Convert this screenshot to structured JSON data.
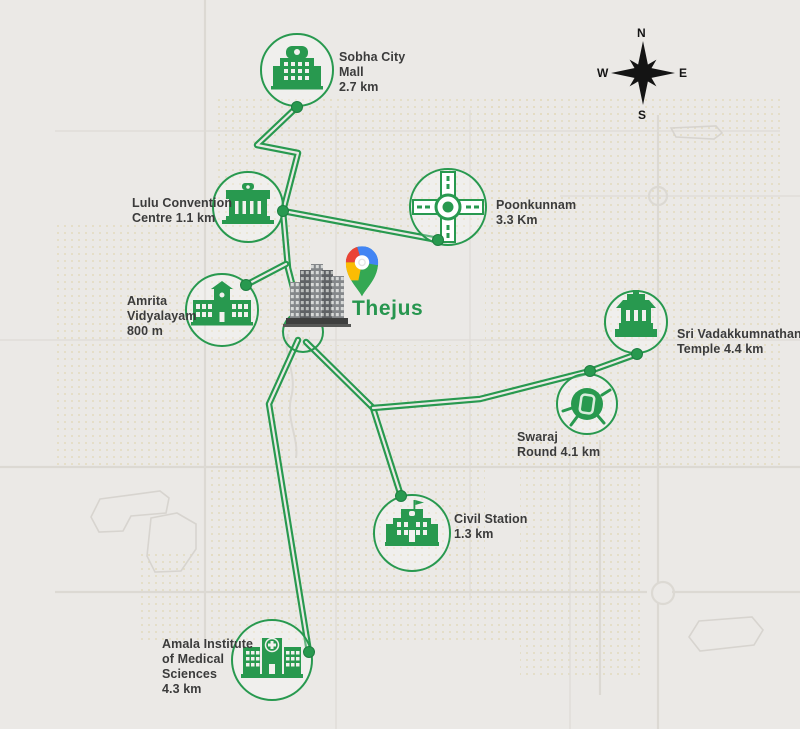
{
  "colors": {
    "accent_green": "#28994f",
    "label_text": "#3b3b3b",
    "background": "#ebe9e6",
    "compass_black": "#141414",
    "pin_red": "#EA4335",
    "pin_blue": "#4285F4",
    "pin_yellow": "#FBBC04",
    "pin_green": "#34A853"
  },
  "project": {
    "name": "Thejus",
    "pin_icon": "google-maps-pin",
    "building_icon": "highrise-tower-illustration"
  },
  "compass": {
    "north": "N",
    "south": "S",
    "east": "E",
    "west": "W"
  },
  "locations": [
    {
      "name": "Sobha City Mall",
      "distance": "2.7 km",
      "icon": "mall-icon",
      "lines": [
        "Sobha City",
        "Mall",
        "2.7 km"
      ]
    },
    {
      "name": "Lulu Convention Centre",
      "distance": "1.1 km",
      "icon": "convention-centre-icon",
      "lines": [
        "Lulu Convention",
        "Centre 1.1 km"
      ]
    },
    {
      "name": "Poonkunnam",
      "distance": "3.3 Km",
      "icon": "roundabout-icon",
      "lines": [
        "Poonkunnam",
        "3.3 Km"
      ]
    },
    {
      "name": "Amrita Vidyalayam",
      "distance": "800 m",
      "icon": "school-icon",
      "lines": [
        "Amrita",
        "Vidyalayam",
        "800 m"
      ]
    },
    {
      "name": "Sri Vadakkumnathan Temple",
      "distance": "4.4 km",
      "icon": "temple-icon",
      "lines": [
        "Sri Vadakkumnathan",
        "Temple 4.4 km"
      ]
    },
    {
      "name": "Swaraj Round",
      "distance": "4.1 km",
      "icon": "swaraj-round-icon",
      "lines": [
        "Swaraj",
        "Round 4.1 km"
      ]
    },
    {
      "name": "Civil Station",
      "distance": "1.3 km",
      "icon": "government-building-icon",
      "lines": [
        "Civil Station",
        "1.3 km"
      ]
    },
    {
      "name": "Amala Institute of Medical Sciences",
      "distance": "4.3 km",
      "icon": "hospital-icon",
      "lines": [
        "Amala Institute",
        "of Medical",
        "Sciences",
        "4.3 km"
      ]
    }
  ]
}
